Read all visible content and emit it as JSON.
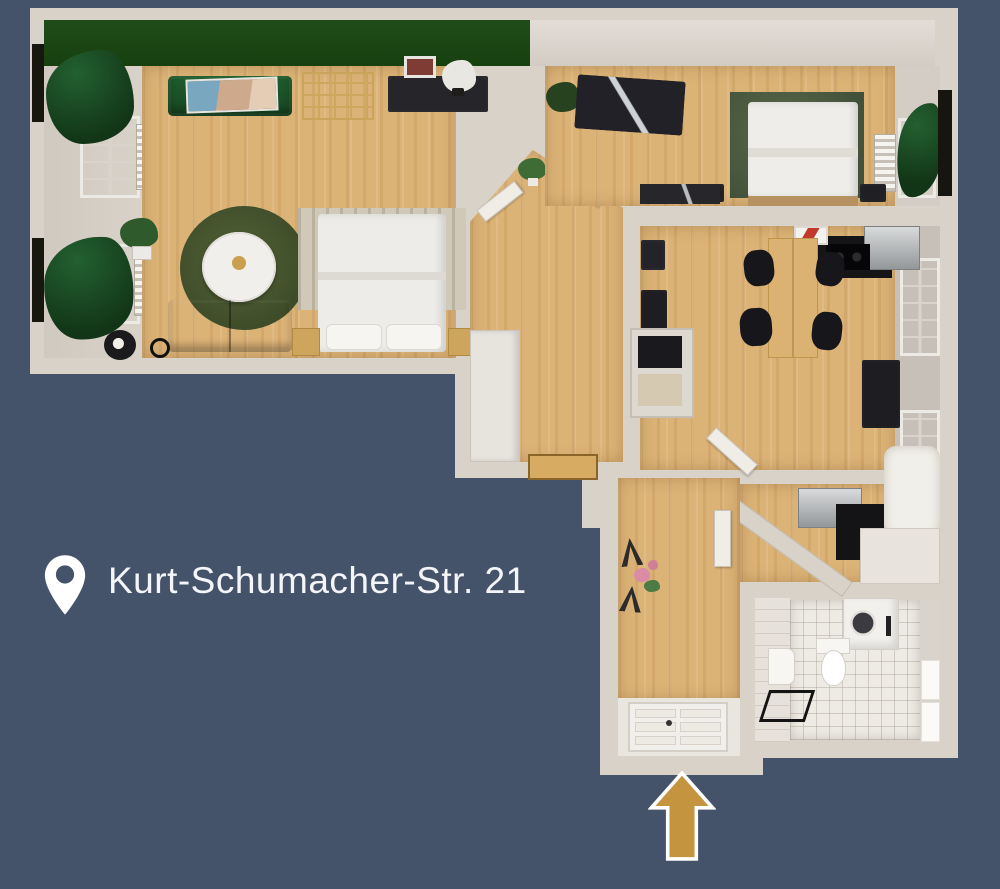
{
  "scene": {
    "type": "3d-floorplan-render",
    "address": {
      "label": "Kurt-Schumacher-Str. 21"
    },
    "entrance": {
      "arrow_direction": "up"
    },
    "icons": {
      "pin": "location-pin-icon",
      "arrow": "entrance-arrow-icon"
    },
    "colors": {
      "background": "#45536a",
      "wall": "#d8d2c9",
      "wall_face": "#d5cfc6",
      "wood": "#dcb377",
      "accent_green": "#1d4617",
      "sofa_green": "#1b5226",
      "curtain_green": "#174420",
      "rug_olive": "#4a5530",
      "bedroom_rug": "#4d5c40",
      "arrow_gold": "#c5943f",
      "tile": "#eeebe5",
      "dark_furn": "#1f1f24",
      "door_white": "#f1efeb"
    },
    "rooms": [
      "living-room",
      "hallway",
      "bedroom",
      "kitchen-dining",
      "small-bedroom",
      "bathroom",
      "entrance-hall"
    ]
  }
}
